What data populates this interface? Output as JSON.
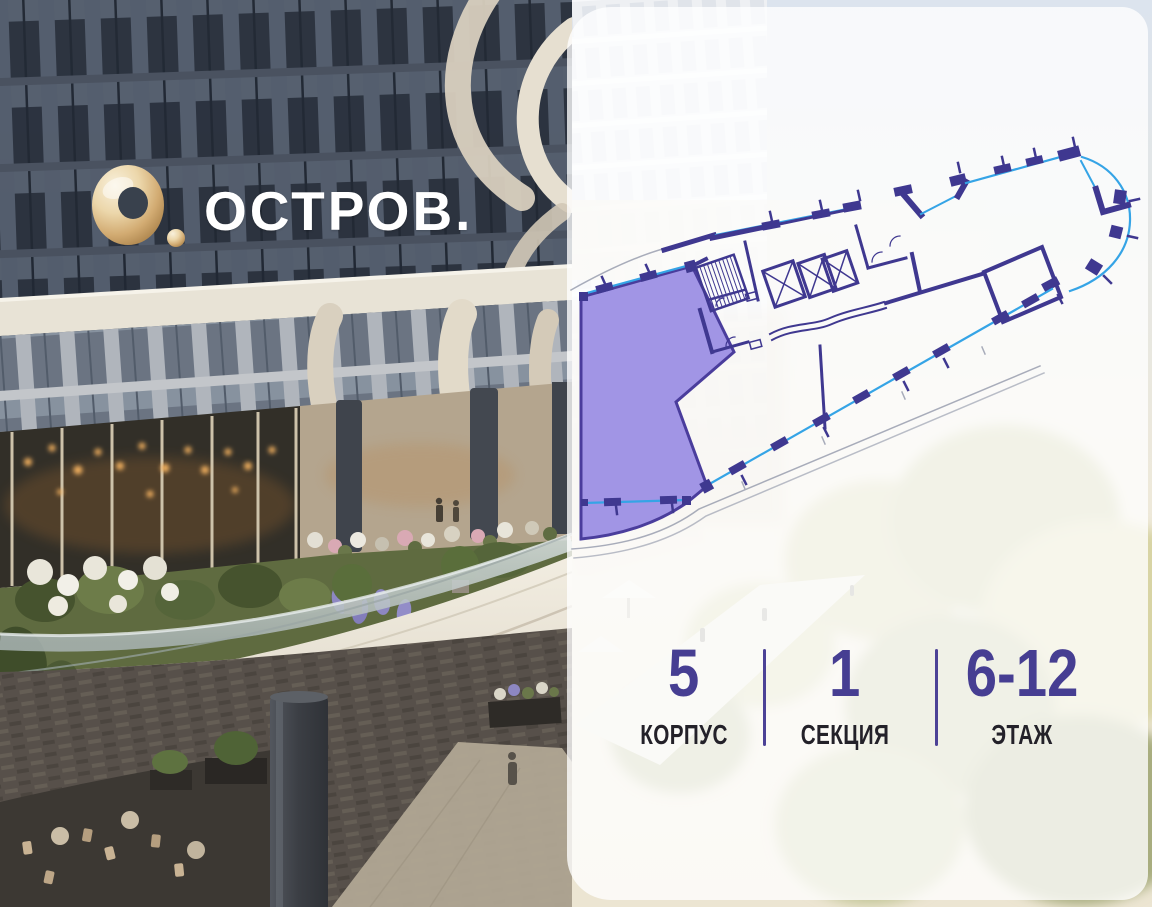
{
  "brand": {
    "logo_text": "ОСТРОВ."
  },
  "selection": {
    "stats": [
      {
        "value": "5",
        "label": "КОРПУС"
      },
      {
        "value": "1",
        "label": "СЕКЦИЯ"
      },
      {
        "value": "6-12",
        "label": "ЭТАЖ"
      }
    ]
  },
  "floor_plan": {
    "highlighted_unit_selected": true,
    "colors": {
      "unit_fill": "#9c8fe4",
      "unit_border": "#4a3d9c",
      "walls": "#3f3890",
      "glazing": "#35a4e6",
      "accent_numbers": "#463e92",
      "label_text": "#232129",
      "panel_overlay": "rgba(255,255,255,0.78)",
      "logo_gold": "#d2ab72"
    }
  }
}
